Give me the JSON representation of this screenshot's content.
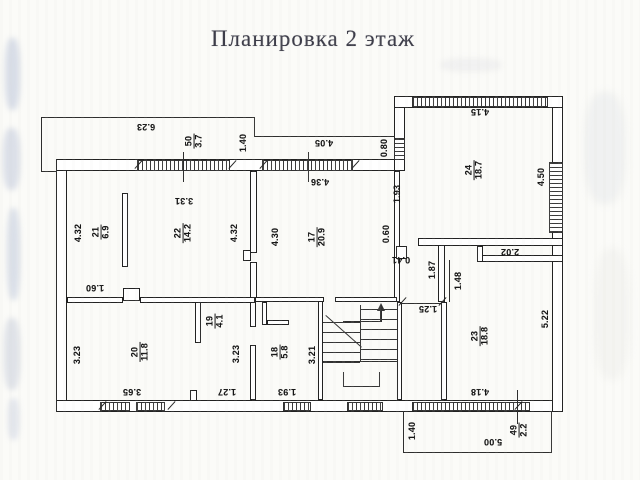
{
  "title": "Планировка 2 этаж",
  "plan": {
    "room_labels": [
      {
        "number": "21",
        "area": "6.9",
        "x": 101,
        "y": 232
      },
      {
        "number": "22",
        "area": "14.2",
        "x": 183,
        "y": 233
      },
      {
        "number": "17",
        "area": "20.9",
        "x": 317,
        "y": 237
      },
      {
        "number": "24",
        "area": "18.7",
        "x": 474,
        "y": 170
      },
      {
        "number": "19",
        "area": "4.1",
        "x": 215,
        "y": 321
      },
      {
        "number": "20",
        "area": "11.8",
        "x": 140,
        "y": 352
      },
      {
        "number": "18",
        "area": "5.8",
        "x": 280,
        "y": 352
      },
      {
        "number": "23",
        "area": "18.8",
        "x": 480,
        "y": 336
      }
    ],
    "window_codes": [
      {
        "code": "50",
        "area": "3.7",
        "x": 194,
        "y": 141
      },
      {
        "code": "49",
        "area": "2.2",
        "x": 519,
        "y": 430
      }
    ],
    "dimensions_vertical": [
      {
        "text": "4.32",
        "x": 78,
        "y": 233
      },
      {
        "text": "4.32",
        "x": 234,
        "y": 233
      },
      {
        "text": "4.30",
        "x": 275,
        "y": 237
      },
      {
        "text": "1.40",
        "x": 243,
        "y": 143
      },
      {
        "text": "0.80",
        "x": 384,
        "y": 148
      },
      {
        "text": "1.93",
        "x": 397,
        "y": 194
      },
      {
        "text": "0.60",
        "x": 386,
        "y": 234
      },
      {
        "text": "4.50",
        "x": 541,
        "y": 177
      },
      {
        "text": "1.87",
        "x": 432,
        "y": 270
      },
      {
        "text": "1.48",
        "x": 458,
        "y": 281
      },
      {
        "text": "5.22",
        "x": 545,
        "y": 319
      },
      {
        "text": "3.23",
        "x": 77,
        "y": 355
      },
      {
        "text": "3.23",
        "x": 236,
        "y": 354
      },
      {
        "text": "3.21",
        "x": 312,
        "y": 355
      },
      {
        "text": "1.40",
        "x": 412,
        "y": 431
      }
    ],
    "dimensions_flipped": [
      {
        "text": "6.23",
        "x": 146,
        "y": 127
      },
      {
        "text": "4.05",
        "x": 324,
        "y": 143
      },
      {
        "text": "4.36",
        "x": 320,
        "y": 182
      },
      {
        "text": "3.31",
        "x": 184,
        "y": 201
      },
      {
        "text": "4.15",
        "x": 480,
        "y": 112
      },
      {
        "text": "1.60",
        "x": 95,
        "y": 288
      },
      {
        "text": "2.02",
        "x": 510,
        "y": 252
      },
      {
        "text": "1.25",
        "x": 428,
        "y": 309
      },
      {
        "text": "0.41",
        "x": 401,
        "y": 260
      },
      {
        "text": "3.65",
        "x": 132,
        "y": 392
      },
      {
        "text": "1.27",
        "x": 227,
        "y": 392
      },
      {
        "text": "1.93",
        "x": 287,
        "y": 392
      },
      {
        "text": "4.18",
        "x": 480,
        "y": 392
      },
      {
        "text": "5.00",
        "x": 493,
        "y": 442
      }
    ]
  }
}
